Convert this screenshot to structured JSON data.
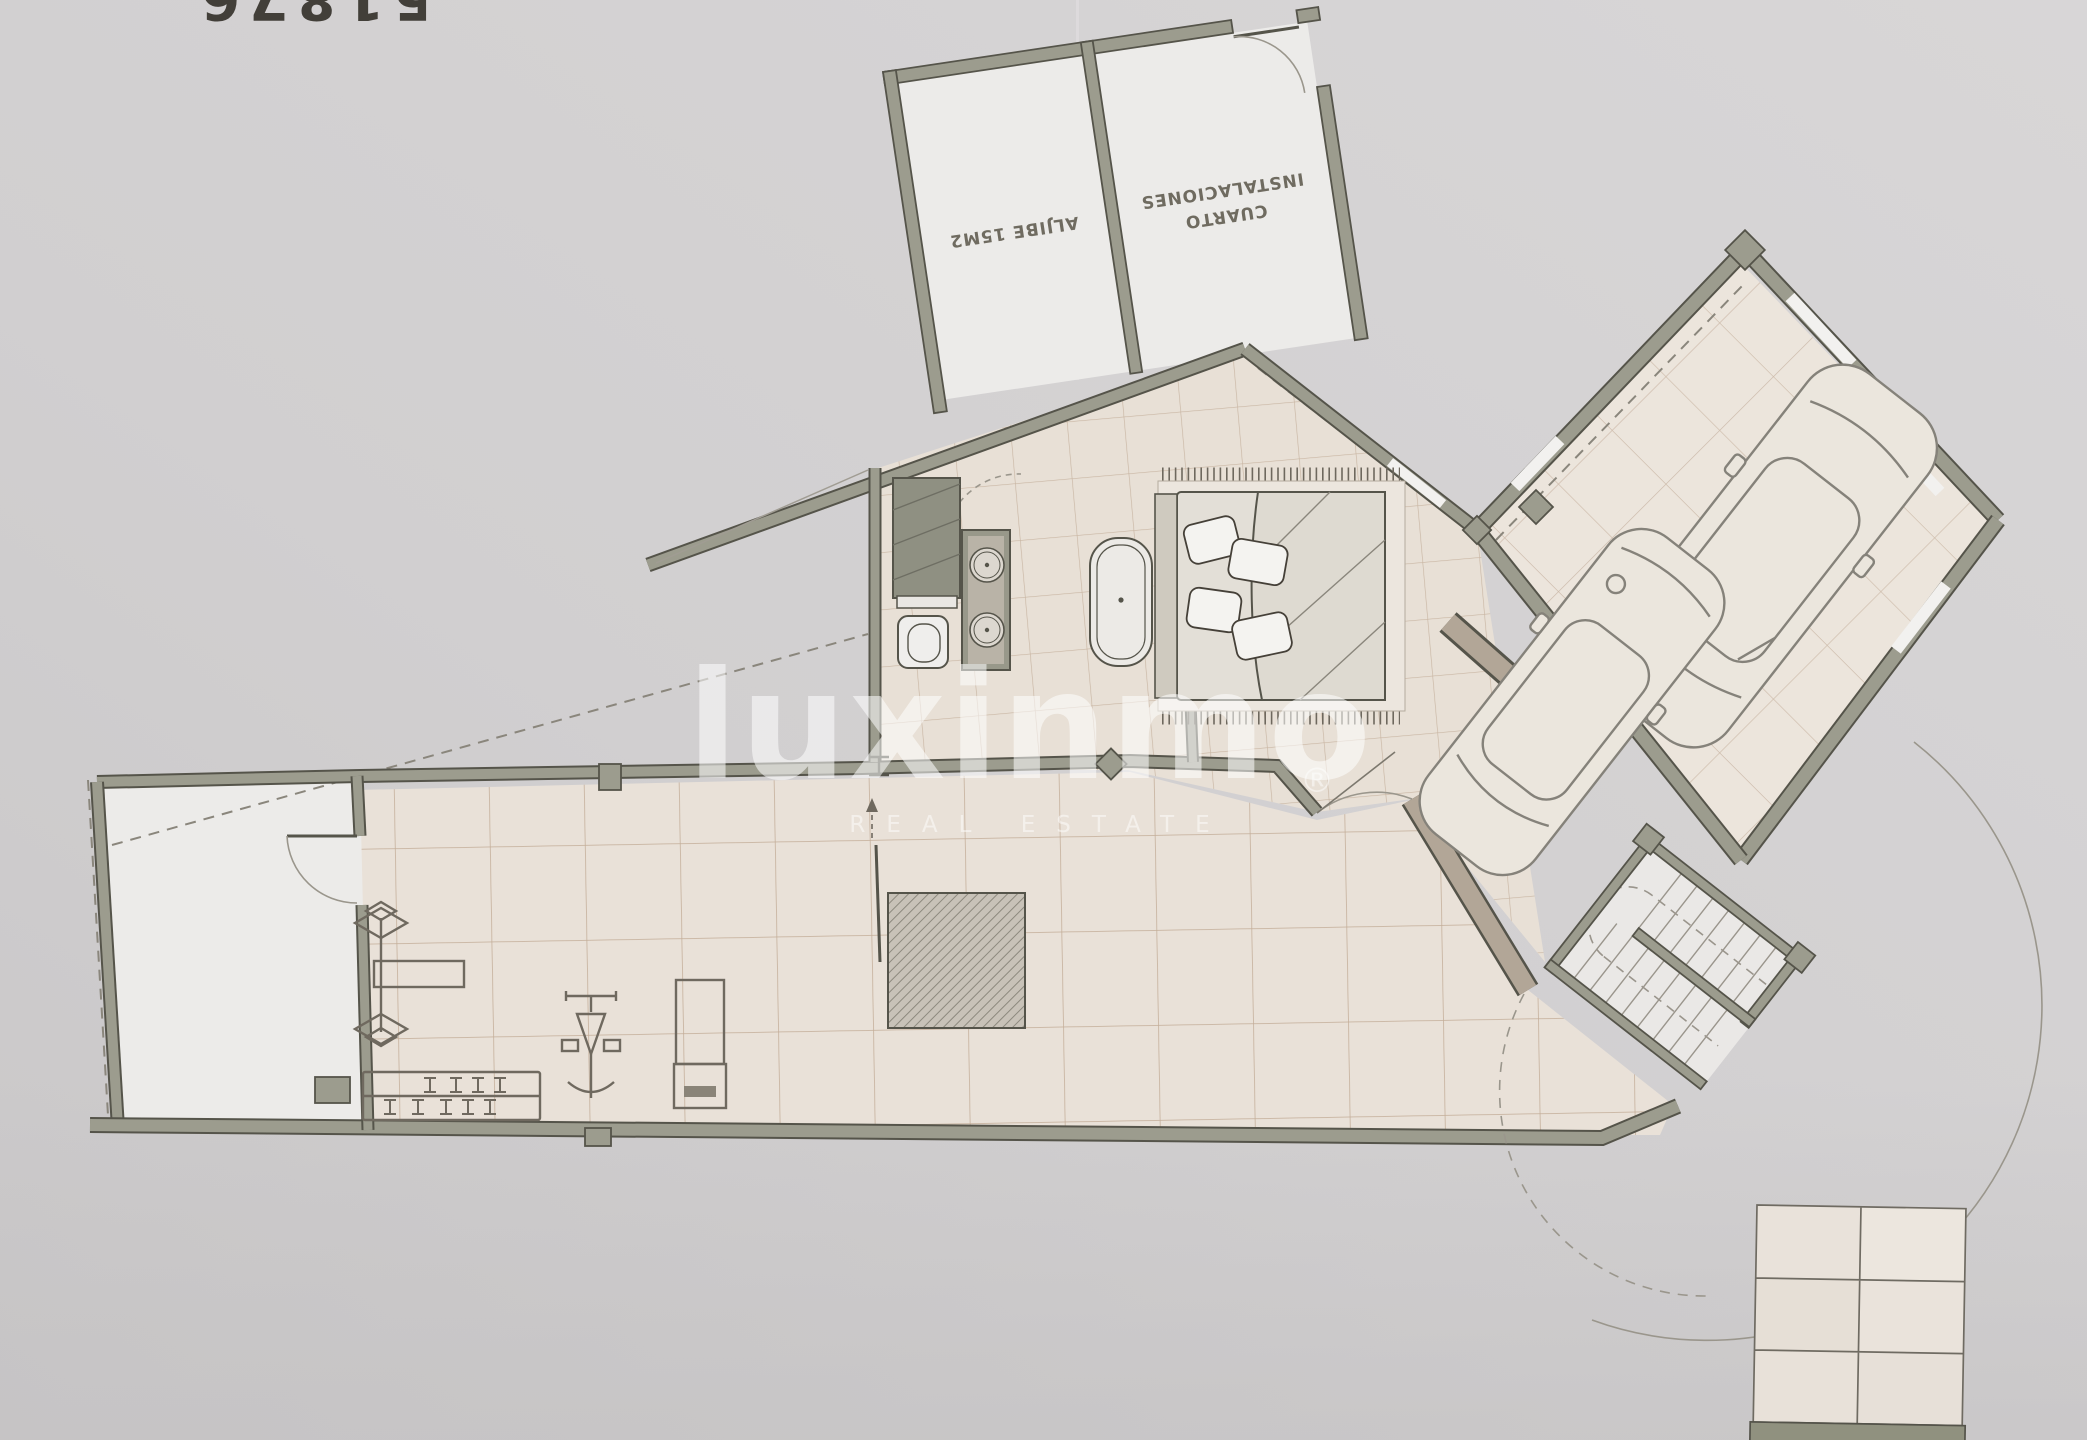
{
  "photo": {
    "top_left_fragment": "51876"
  },
  "plan": {
    "rooms": {
      "aljibe": {
        "label": "ALJIBE 15M2"
      },
      "cuarto": {
        "line1": "INSTALACIONES",
        "line2": "CUARTO"
      }
    },
    "legend": {
      "caption": "60X120 = 125M2"
    }
  },
  "watermark": {
    "brand": "luxinmo",
    "registered": "®",
    "tagline": "REAL ESTATE"
  },
  "colors": {
    "paper": "#d2d0d1",
    "wall": "#9c9c8e",
    "wall_outline": "#55544a",
    "tan_wall": "#b2a697",
    "floor_tile": "#e8e0d6",
    "grout": "#c9b6a3",
    "garage_tile": "#ece5dc",
    "white_floor": "#ecebe9",
    "watermark": "#ffffff"
  }
}
